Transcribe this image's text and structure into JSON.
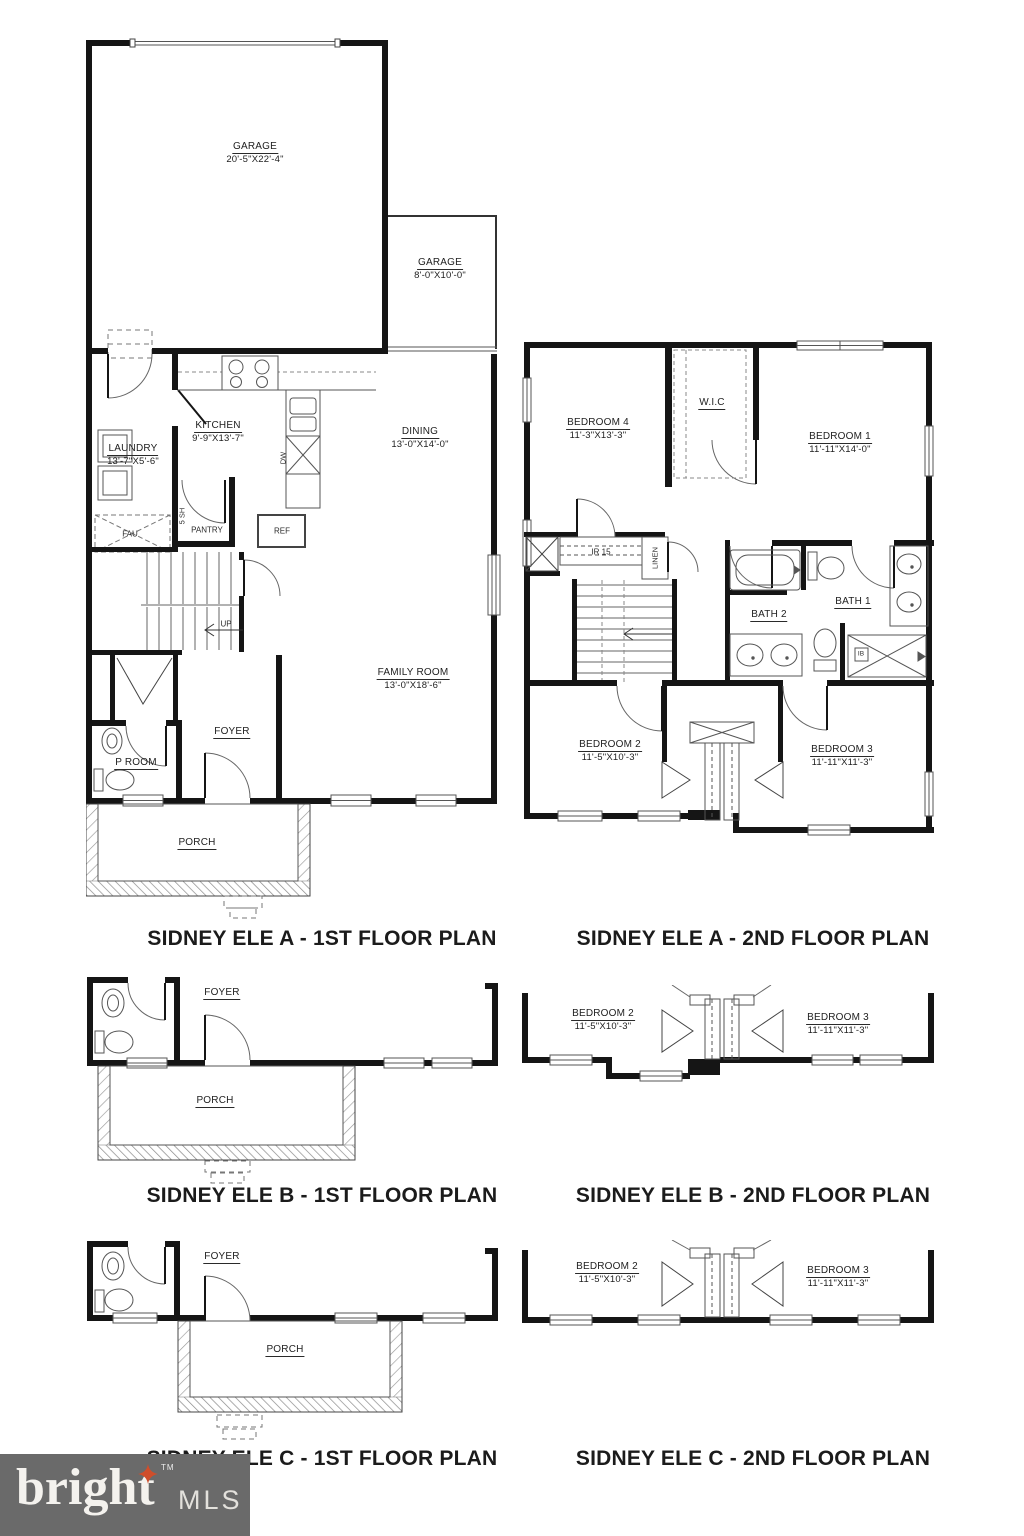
{
  "plans": {
    "a1": {
      "caption": "SIDNEY ELE A - 1ST FLOOR PLAN",
      "garage_main": {
        "name": "GARAGE",
        "dims": "20'-5\"X22'-4\""
      },
      "garage_small": {
        "name": "GARAGE",
        "dims": "8'-0\"X10'-0\""
      },
      "kitchen": {
        "name": "KITCHEN",
        "dims": "9'-9\"X13'-7\""
      },
      "laundry": {
        "name": "LAUNDRY",
        "dims": "13'-7\"X5'-6\""
      },
      "dining": {
        "name": "DINING",
        "dims": "13'-0\"X14'-0\""
      },
      "family_room": {
        "name": "FAMILY ROOM",
        "dims": "13'-0\"X18'-6\""
      },
      "foyer": {
        "name": "FOYER"
      },
      "p_room": {
        "name": "P ROOM"
      },
      "porch": {
        "name": "PORCH"
      },
      "pantry": {
        "name": "PANTRY"
      },
      "ref": {
        "name": "REF"
      },
      "fau": {
        "name": "FAU"
      },
      "dw": {
        "name": "DW"
      },
      "shelves": {
        "name": "5 SH"
      },
      "up": {
        "name": "UP"
      }
    },
    "a2": {
      "caption": "SIDNEY ELE A - 2ND FLOOR PLAN",
      "bedroom1": {
        "name": "BEDROOM 1",
        "dims": "11'-11\"X14'-0\""
      },
      "bedroom2": {
        "name": "BEDROOM 2",
        "dims": "11'-5\"X10'-3\""
      },
      "bedroom3": {
        "name": "BEDROOM 3",
        "dims": "11'-11\"X11'-3\""
      },
      "bedroom4": {
        "name": "BEDROOM 4",
        "dims": "11'-3\"X13'-3\""
      },
      "wic": {
        "name": "W.I.C"
      },
      "bath1": {
        "name": "BATH 1"
      },
      "bath2": {
        "name": "BATH 2"
      },
      "stairs": {
        "name": "IR 15"
      },
      "linen": {
        "name": "LINEN"
      },
      "shower": {
        "name": "IB"
      }
    },
    "b1": {
      "caption": "SIDNEY ELE B - 1ST FLOOR PLAN",
      "foyer": {
        "name": "FOYER"
      },
      "porch": {
        "name": "PORCH"
      }
    },
    "b2": {
      "caption": "SIDNEY ELE B - 2ND FLOOR PLAN",
      "bedroom2": {
        "name": "BEDROOM 2",
        "dims": "11'-5\"X10'-3\""
      },
      "bedroom3": {
        "name": "BEDROOM 3",
        "dims": "11'-11\"X11'-3\""
      }
    },
    "c1": {
      "caption": "SIDNEY ELE C - 1ST FLOOR PLAN",
      "foyer": {
        "name": "FOYER"
      },
      "porch": {
        "name": "PORCH"
      }
    },
    "c2": {
      "caption": "SIDNEY ELE C - 2ND FLOOR PLAN",
      "bedroom2": {
        "name": "BEDROOM 2",
        "dims": "11'-5\"X10'-3\""
      },
      "bedroom3": {
        "name": "BEDROOM 3",
        "dims": "11'-11\"X11'-3\""
      }
    }
  },
  "logo": {
    "brand": "bright",
    "tm": "TM",
    "suffix": "MLS",
    "background": "#6a6a6a",
    "star_color": "#cf4e2b"
  }
}
